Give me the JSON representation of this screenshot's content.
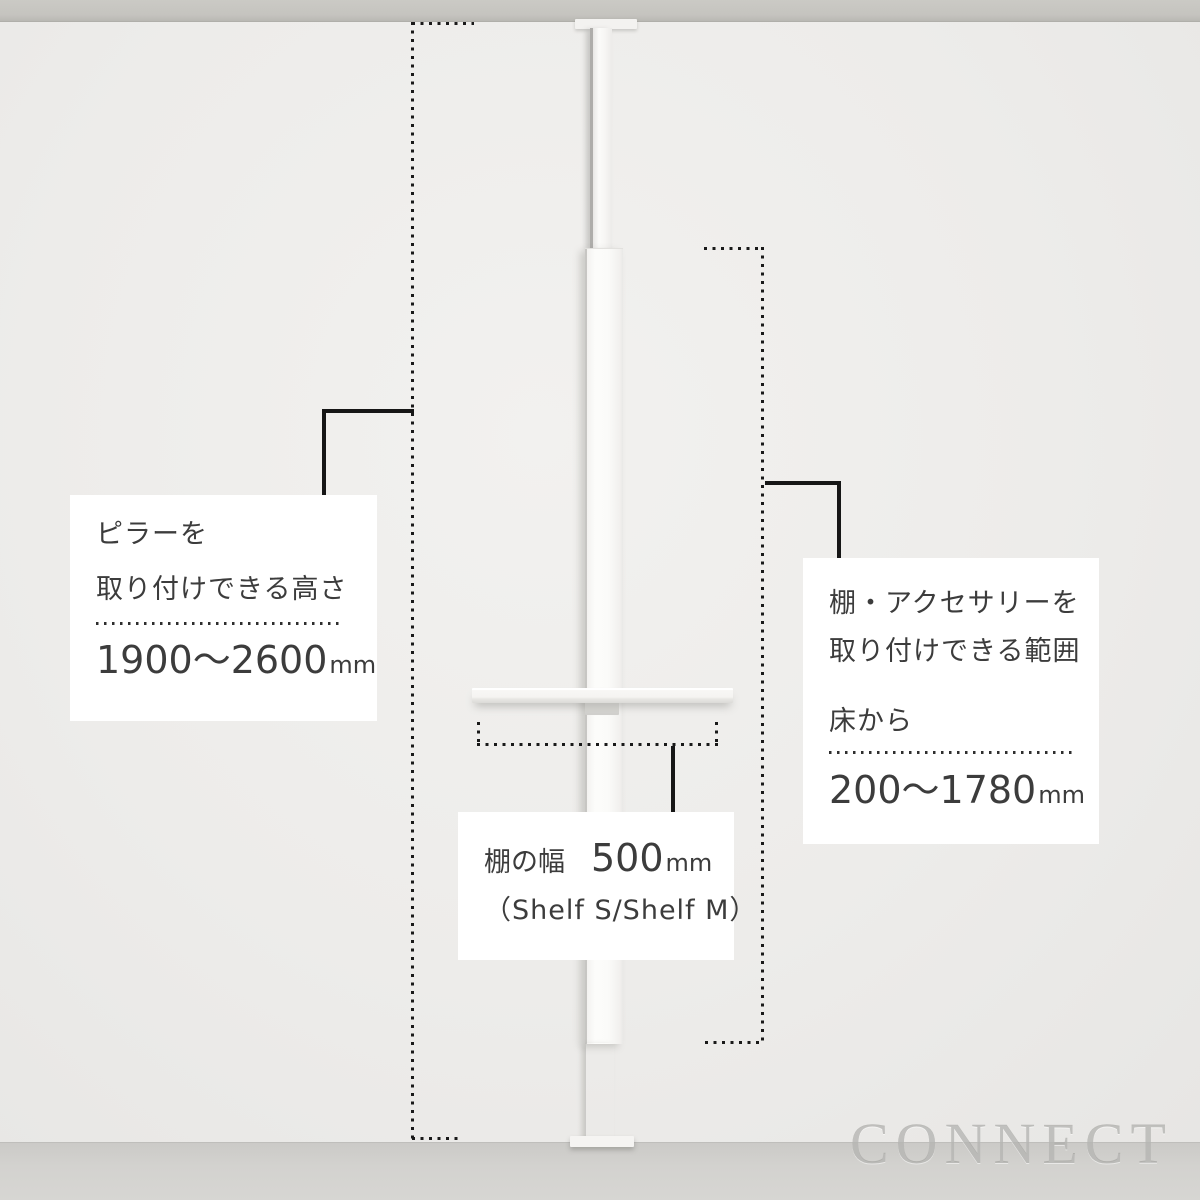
{
  "watermark": "CONNECT",
  "labels": {
    "pillar": {
      "line1": "ピラーを",
      "line2": "取り付けできる高さ",
      "value": "1900〜2600",
      "unit": "mm"
    },
    "range": {
      "line1": "棚・アクセサリーを",
      "line2": "取り付けできる範囲",
      "line3": "床から",
      "value": "200〜1780",
      "unit": "mm"
    },
    "shelf": {
      "label": "棚の幅",
      "value": "500",
      "unit": "mm",
      "note": "（Shelf S/Shelf M）"
    }
  },
  "colors": {
    "wall": "#edecea",
    "ceiling": "#c5c4bf",
    "floor": "#d3d2cf",
    "product_white": "#fafaf8",
    "annotation_black": "#161616",
    "label_text": "#3c3c3c",
    "box_background": "#ffffff",
    "watermark_gray": "#969592"
  }
}
